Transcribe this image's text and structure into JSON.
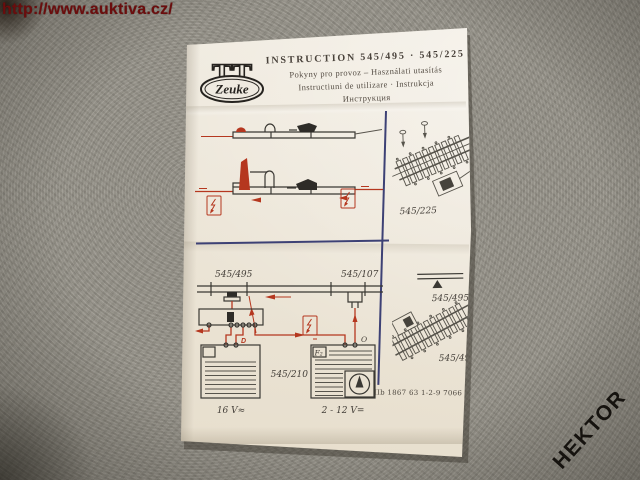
{
  "watermark": {
    "url": "http://www.auktiva.cz/"
  },
  "stamp": {
    "text": "HEKTOR"
  },
  "sheet": {
    "logo": {
      "tt": "TT",
      "brand": "Zeuke"
    },
    "header": {
      "title": "INSTRUCTION 545/495 · 545/225",
      "line2": "Pokyny pro provoz – Használati utasítás",
      "line3": "Instructiuni de utilizare · Instrukcja",
      "line4": "Инструкция"
    },
    "wiring": {
      "uncoupler_label": "545/495",
      "feeder_label": "545/107",
      "controller_label": "545/210",
      "trafo_ac_label": "16 V≈",
      "trafo_dc_label": "2 - 12 V=",
      "fuse_label": "F₂",
      "terminal_o": "O",
      "terminal_d": "D"
    },
    "right_panel": {
      "top_caption": "545/225",
      "symbol_caption": "545/495",
      "bottom_caption": "545/495"
    },
    "footer": {
      "print_code": "IIb 1867 63 1-2-9 7066"
    }
  },
  "colors": {
    "watermark_red": "#6b0d0d",
    "diagram_red": "#b5371f",
    "divider_navy": "#3d4175",
    "paper": "#efe9dd",
    "fabric_grey": "#98958c",
    "ink": "#3a3833",
    "stamp_black": "#16130f"
  }
}
